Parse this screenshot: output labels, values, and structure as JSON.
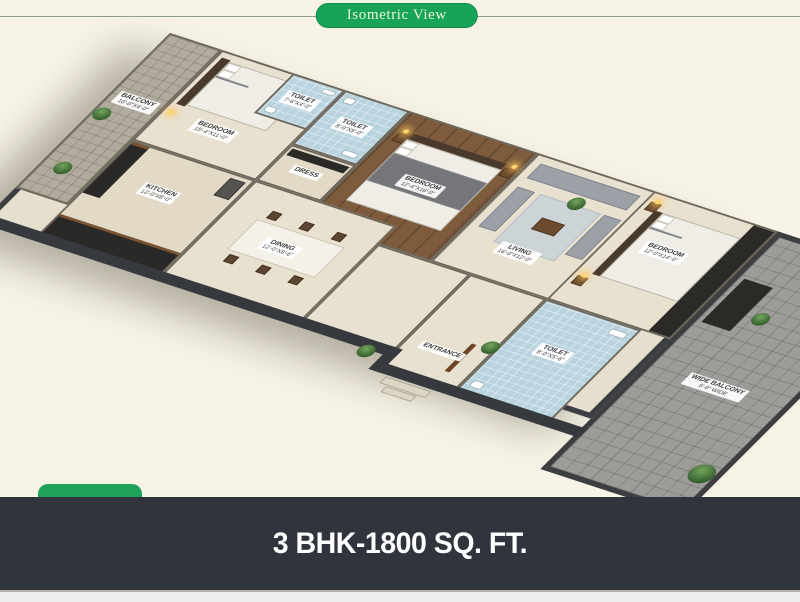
{
  "header": {
    "title": "Isometric View"
  },
  "footer": {
    "title": "3 BHK-1800 SQ. FT."
  },
  "colors": {
    "background": "#f7f3e6",
    "accent_green": "#17a457",
    "footer_bg": "#2f343d",
    "footer_text": "#ffffff",
    "toilet_blue": "#b9d4de",
    "wood_brown": "#7d5b3c",
    "balcony_gray": "#9d9c99",
    "floor_cream": "#e7dfce",
    "wall_dark": "#3c3e42"
  },
  "rooms": {
    "balcony_top": {
      "name": "BALCONY",
      "dims": "10'-0\"X4'-0\""
    },
    "bedroom_1": {
      "name": "BEDROOM",
      "dims": "15'-4\"X11'-0\""
    },
    "toilet_1": {
      "name": "TOILET",
      "dims": "7'-6\"X4'-0\""
    },
    "toilet_2": {
      "name": "TOILET",
      "dims": "8'-0\"X5'-0\""
    },
    "dress": {
      "name": "DRESS"
    },
    "kitchen": {
      "name": "KITCHEN",
      "dims": "12'-0\"X8'-0\""
    },
    "master_bedroom": {
      "name": "BEDROOM",
      "dims": "12'-4\"X16'-0\""
    },
    "dining": {
      "name": "DINING",
      "dims": "12'-0\"X8'-6\""
    },
    "living": {
      "name": "LIVING",
      "dims": "16'-0\"X12'-0\""
    },
    "bedroom_2": {
      "name": "BEDROOM",
      "dims": "12'-0\"X14'-0\""
    },
    "toilet_3": {
      "name": "TOILET",
      "dims": "8'-0\"X5'-6\""
    },
    "entrance": {
      "name": "ENTRANCE"
    },
    "wide_balcony": {
      "name": "WIDE BALCONY",
      "dims": "5'-0\" WIDE"
    }
  }
}
